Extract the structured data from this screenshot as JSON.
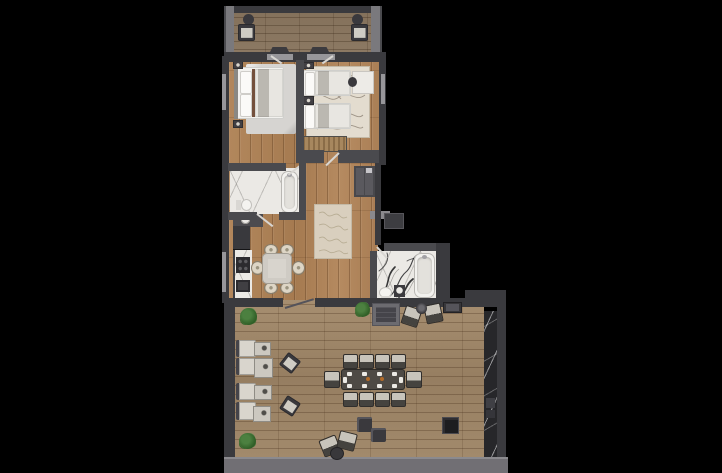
{
  "document": {
    "type": "architectural-floor-plan",
    "view": "top-down 3d render of an apartment with terrace on black background"
  },
  "palette": {
    "background": "#000000",
    "wall": "#4a4a4e",
    "wall_dark": "#3a3a3e",
    "wall_light": "#7a797d",
    "window": "#97969a",
    "marble_light": "#ebe9e5",
    "marble_dark": "#27272a",
    "rug_gray": "#d6d4d1",
    "fabric_light": "#d9d5cd",
    "furniture_dark": "#3a393d",
    "bed_white": "#f2f1ee",
    "duvet": "#e8e6e1",
    "accent_brown": "#74503c",
    "wood_bench": "#a7875e",
    "plant_green": "#2f5e26",
    "table_dark": "#4e4a45",
    "centerpiece_orange": "#b06a28",
    "deck_edge": "#716f74"
  },
  "rooms": [
    {
      "id": "balcony",
      "floor": "wood deck"
    },
    {
      "id": "bedroom-1",
      "floor": "wood"
    },
    {
      "id": "bedroom-2",
      "floor": "wood"
    },
    {
      "id": "bathroom-1",
      "floor": "light marble"
    },
    {
      "id": "hallway",
      "floor": "wood"
    },
    {
      "id": "kitchen-dining",
      "floor": "wood"
    },
    {
      "id": "bathroom-2",
      "floor": "veined marble"
    },
    {
      "id": "terrace",
      "floor": "wood deck"
    }
  ],
  "inventory": [
    {
      "room": "balcony",
      "items": [
        "armchair x2",
        "round side table x2"
      ]
    },
    {
      "room": "bedroom-1",
      "items": [
        "double bed",
        "nightstand x2",
        "area rug"
      ]
    },
    {
      "room": "bedroom-2",
      "items": [
        "single bed x2",
        "nightstand x2",
        "desk",
        "chair",
        "slatted bench",
        "patterned rug"
      ]
    },
    {
      "room": "bathroom-1",
      "items": [
        "bathtub",
        "vanity sink",
        "toilet"
      ]
    },
    {
      "room": "hallway",
      "items": [
        "runner rug",
        "wardrobe",
        "utility unit"
      ]
    },
    {
      "room": "kitchen-dining",
      "items": [
        "tall cabinets",
        "counter with cooktop and sink",
        "dining table",
        "dining chair x6"
      ]
    },
    {
      "room": "bathroom-2",
      "items": [
        "bathtub",
        "vanity sink",
        "toilet"
      ]
    },
    {
      "room": "terrace",
      "items": [
        "lounge seat x4",
        "side table x4",
        "cube chair x2",
        "long dining table",
        "dining chair x10",
        "ottoman x2",
        "armchair x4",
        "round table x2",
        "fire table",
        "planter",
        "plant x3",
        "dark marble feature wall"
      ]
    }
  ]
}
